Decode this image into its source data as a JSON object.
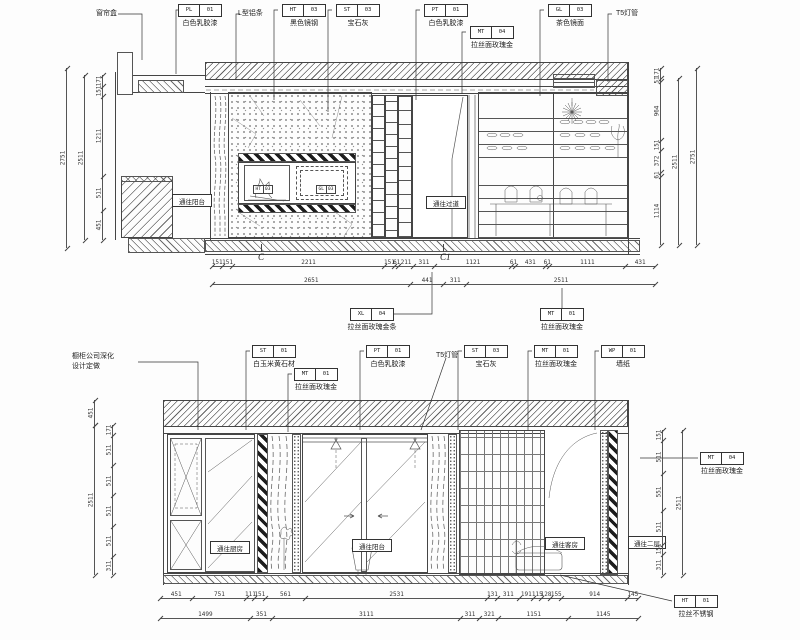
{
  "ink": "#3a3a3a",
  "elev1": {
    "top_callouts": [
      {
        "type": "text",
        "text": "窗帘盒",
        "x": 96,
        "y": 8
      },
      {
        "type": "tag",
        "code": "PL",
        "num": "01",
        "label": "白色乳胶漆",
        "x": 178,
        "y": 4
      },
      {
        "type": "text",
        "text": "L型铝条",
        "x": 238,
        "y": 8
      },
      {
        "type": "tag",
        "code": "HT",
        "num": "03",
        "label": "黑色镜钢",
        "x": 282,
        "y": 4
      },
      {
        "type": "tag",
        "code": "ST",
        "num": "03",
        "label": "宝石灰",
        "x": 336,
        "y": 4
      },
      {
        "type": "tag",
        "code": "PT",
        "num": "01",
        "label": "白色乳胶漆",
        "x": 424,
        "y": 4
      },
      {
        "type": "tag",
        "code": "MT",
        "num": "04",
        "label": "拉丝面玫瑰金",
        "x": 470,
        "y": 26
      },
      {
        "type": "tag",
        "code": "GL",
        "num": "03",
        "label": "茶色镜面",
        "x": 548,
        "y": 4
      },
      {
        "type": "text",
        "text": "T5灯管",
        "x": 616,
        "y": 8
      }
    ],
    "bottom_callouts": [
      {
        "type": "tag",
        "code": "XL",
        "num": "04",
        "label": "拉丝面玫瑰金条",
        "x": 350,
        "y": 308
      },
      {
        "type": "tag",
        "code": "MT",
        "num": "01",
        "label": "拉丝面玫瑰金",
        "x": 540,
        "y": 308
      }
    ],
    "room_labels": [
      {
        "text": "通往阳台",
        "x": 172,
        "y": 194,
        "w": 40,
        "h": 13
      },
      {
        "text": "通往过道",
        "x": 426,
        "y": 196,
        "w": 40,
        "h": 13
      }
    ],
    "mini_tags": [
      {
        "code": "HT",
        "num": "03",
        "x": 253,
        "y": 185
      },
      {
        "code": "GL",
        "num": "03",
        "x": 316,
        "y": 185
      }
    ],
    "sections": [
      {
        "text": "C",
        "x": 258,
        "y": 252
      },
      {
        "text": "C1",
        "x": 440,
        "y": 252
      }
    ]
  },
  "elev2": {
    "top_callouts": [
      {
        "type": "note",
        "lines": [
          "橱柜公司深化",
          "设计定做"
        ],
        "x": 72,
        "y": 352
      },
      {
        "type": "tag",
        "code": "ST",
        "num": "01",
        "label": "白玉米黄石材",
        "x": 252,
        "y": 345
      },
      {
        "type": "tag",
        "code": "MT",
        "num": "01",
        "label": "拉丝面玫瑰金",
        "x": 294,
        "y": 368
      },
      {
        "type": "tag",
        "code": "PT",
        "num": "01",
        "label": "白色乳胶漆",
        "x": 366,
        "y": 345
      },
      {
        "type": "text",
        "text": "T5灯管",
        "x": 436,
        "y": 350
      },
      {
        "type": "tag",
        "code": "ST",
        "num": "03",
        "label": "宝石灰",
        "x": 464,
        "y": 345
      },
      {
        "type": "tag",
        "code": "MT",
        "num": "01",
        "label": "拉丝面玫瑰金",
        "x": 534,
        "y": 345
      },
      {
        "type": "tag",
        "code": "WP",
        "num": "01",
        "label": "墙纸",
        "x": 601,
        "y": 345
      }
    ],
    "side_callouts": [
      {
        "type": "tag",
        "code": "MT",
        "num": "04",
        "label": "拉丝面玫瑰金",
        "x": 700,
        "y": 452
      }
    ],
    "bottom_callouts": [
      {
        "type": "tag",
        "code": "HT",
        "num": "01",
        "label": "拉丝不锈钢",
        "x": 674,
        "y": 595
      }
    ],
    "room_labels": [
      {
        "text": "通往厨房",
        "x": 210,
        "y": 541,
        "w": 40,
        "h": 13
      },
      {
        "text": "通往阳台",
        "x": 352,
        "y": 539,
        "w": 40,
        "h": 13
      },
      {
        "text": "通往客房",
        "x": 545,
        "y": 537,
        "w": 40,
        "h": 13
      },
      {
        "text": "通往二层",
        "x": 628,
        "y": 536,
        "w": 38,
        "h": 13
      }
    ]
  },
  "dim_chains": [
    {
      "o": "h",
      "x": 212,
      "y": 266,
      "len": 443,
      "segs": [
        "151",
        "151",
        "2211",
        "151",
        "61",
        "211",
        "311",
        "1121",
        "61",
        "431",
        "61",
        "1111",
        "431"
      ]
    },
    {
      "o": "h",
      "x": 212,
      "y": 284,
      "len": 443,
      "segs": [
        "2651",
        "441",
        "311",
        "2511"
      ]
    },
    {
      "o": "v",
      "x": 102,
      "y": 75,
      "len": 165,
      "segs": [
        "171",
        "151",
        "1211",
        "511",
        "451"
      ]
    },
    {
      "o": "v",
      "x": 84,
      "y": 75,
      "len": 165,
      "segs": [
        "2511"
      ]
    },
    {
      "o": "v",
      "x": 66,
      "y": 68,
      "len": 180,
      "segs": [
        "2751"
      ]
    },
    {
      "o": "v",
      "x": 660,
      "y": 68,
      "len": 177,
      "segs": [
        "171",
        "51",
        "964",
        "151",
        "372",
        "61",
        "1114"
      ]
    },
    {
      "o": "v",
      "x": 678,
      "y": 78,
      "len": 167,
      "segs": [
        "2511"
      ]
    },
    {
      "o": "v",
      "x": 696,
      "y": 68,
      "len": 177,
      "segs": [
        "2751"
      ]
    },
    {
      "o": "v",
      "x": 112,
      "y": 425,
      "len": 150,
      "segs": [
        "171",
        "511",
        "511",
        "511",
        "511",
        "311"
      ]
    },
    {
      "o": "v",
      "x": 94,
      "y": 400,
      "len": 25,
      "segs": [
        "451"
      ]
    },
    {
      "o": "v",
      "x": 94,
      "y": 425,
      "len": 150,
      "segs": [
        "2511"
      ]
    },
    {
      "o": "v",
      "x": 662,
      "y": 430,
      "len": 145,
      "segs": [
        "151",
        "511",
        "551",
        "511",
        "151",
        "311"
      ]
    },
    {
      "o": "v",
      "x": 682,
      "y": 430,
      "len": 145,
      "segs": [
        "2511"
      ]
    },
    {
      "o": "h",
      "x": 160,
      "y": 598,
      "len": 478,
      "segs": [
        "451",
        "751",
        "111",
        "151",
        "561",
        "2531",
        "131",
        "311",
        "191",
        "115",
        "128",
        "155",
        "914",
        "145"
      ]
    },
    {
      "o": "h",
      "x": 160,
      "y": 618,
      "len": 478,
      "segs": [
        "1499",
        "351",
        "3111",
        "311",
        "321",
        "1151",
        "1145"
      ]
    }
  ]
}
